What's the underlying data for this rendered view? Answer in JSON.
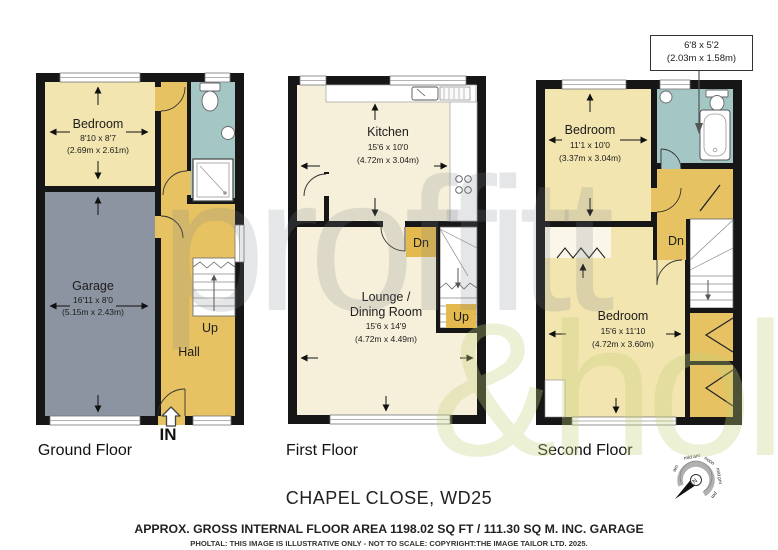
{
  "watermark": {
    "line1": "proffitt",
    "line2": "&holt"
  },
  "floors": {
    "ground": {
      "label": "Ground Floor",
      "bedroom": {
        "name": "Bedroom",
        "imperial": "8'10 x 8'7",
        "metric": "(2.69m x 2.61m)"
      },
      "garage": {
        "name": "Garage",
        "imperial": "16'11 x 8'0",
        "metric": "(5.15m x 2.43m)"
      },
      "hall": {
        "name": "Hall"
      },
      "stairs_up": "Up",
      "entrance": "IN"
    },
    "first": {
      "label": "First Floor",
      "kitchen": {
        "name": "Kitchen",
        "imperial": "15'6 x 10'0",
        "metric": "(4.72m x 3.04m)"
      },
      "lounge": {
        "name_line1": "Lounge /",
        "name_line2": "Dining Room",
        "imperial": "15'6 x 14'9",
        "metric": "(4.72m x 4.49m)"
      },
      "stairs_down": "Dn",
      "stairs_up": "Up"
    },
    "second": {
      "label": "Second Floor",
      "bedroom_front": {
        "name": "Bedroom",
        "imperial": "11'1 x 10'0",
        "metric": "(3.37m x 3.04m)"
      },
      "bedroom_back": {
        "name": "Bedroom",
        "imperial": "15'6 x 11'10",
        "metric": "(4.72m x 3.60m)"
      },
      "bathroom_callout": {
        "imperial": "6'8 x 5'2",
        "metric": "(2.03m x 1.58m)"
      },
      "stairs_down": "Dn"
    }
  },
  "compass": {
    "north": "N",
    "labels": [
      "am",
      "mid am",
      "noon",
      "mid pm",
      "pm"
    ]
  },
  "footer": {
    "title": "CHAPEL CLOSE, WD25",
    "area": "APPROX. GROSS INTERNAL FLOOR AREA 1198.02 SQ FT / 111.30 SQ M. INC. GARAGE",
    "disclaimer": "PHOLTAL: THIS IMAGE IS ILLUSTRATIVE ONLY - NOT TO SCALE: COPYRIGHT:THE IMAGE TAILOR LTD. 2025."
  },
  "colors": {
    "wall": "#161616",
    "bedroom_fill": "#F2E5AF",
    "living_fill": "#F6EFD9",
    "hall_fill": "#E6C262",
    "stair_box_fill": "#E4B94E",
    "bath_fill": "#A4C7C6",
    "garage_fill": "#8C94A1"
  }
}
